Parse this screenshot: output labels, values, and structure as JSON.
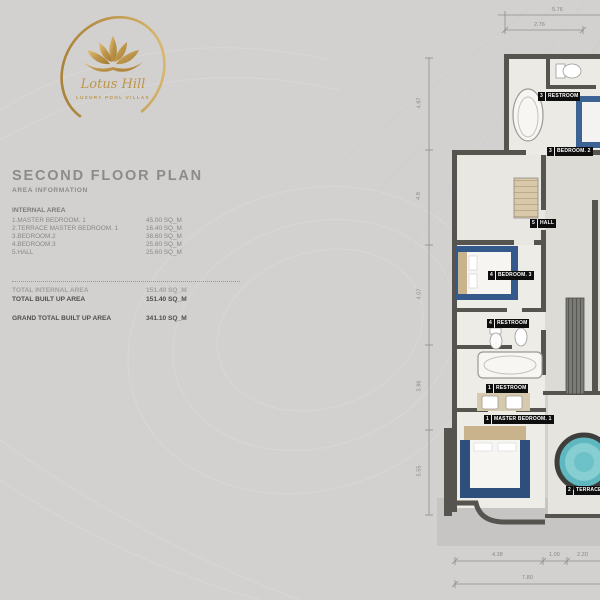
{
  "brand": {
    "name": "Lotus Hill",
    "tagline": "LUXURY POOL VILLAS"
  },
  "heading": {
    "title": "SECOND FLOOR PLAN",
    "subtitle": "AREA INFORMATION"
  },
  "internal_area": {
    "section_label": "INTERNAL AREA",
    "rows": [
      {
        "label": "1.MASTER BEDROOM. 1",
        "value": "45.00 SQ_M"
      },
      {
        "label": "2.TERRACE MASTER BEDROOM. 1",
        "value": "16.40 SQ_M"
      },
      {
        "label": "3.BEDROOM.2",
        "value": "38.60 SQ_M"
      },
      {
        "label": "4.BEDROOM.3",
        "value": "25.80 SQ_M"
      },
      {
        "label": "5.HALL",
        "value": "25.60 SQ_M"
      }
    ]
  },
  "totals": {
    "internal": {
      "label": "TOTAL INTERNAL AREA",
      "value": "151.40 SQ_M"
    },
    "built_up": {
      "label": "TOTAL BUILT UP AREA",
      "value": "151.40 SQ_M"
    },
    "grand": {
      "label": "GRAND TOTAL BUILT UP AREA",
      "value": "341.10 SQ_M"
    }
  },
  "plan": {
    "rooms": [
      {
        "num": "3",
        "name": "RESTROOM"
      },
      {
        "num": "3",
        "name": "BEDROOM. 2"
      },
      {
        "num": "5",
        "name": "HALL"
      },
      {
        "num": "4",
        "name": "BEDROOM. 3"
      },
      {
        "num": "4",
        "name": "RESTROOM"
      },
      {
        "num": "1",
        "name": "RESTROOM"
      },
      {
        "num": "1",
        "name": "MASTER BEDROOM. 1"
      },
      {
        "num": "2",
        "name": "TERRACE"
      }
    ],
    "dimensions": {
      "top_outer": "5.76",
      "top_inner": "2.76",
      "left": [
        "4.97",
        "4.8",
        "4.07",
        "3.96",
        "5.55"
      ],
      "bottom_segments": [
        "4.38",
        "1.00",
        "2.20"
      ],
      "bottom_total": "7.80"
    }
  },
  "colors": {
    "gold": "#bd954a",
    "background": "#d3d1d0",
    "wall": "#56544e",
    "bed_blue": "#35598a",
    "pool_teal": "#5fb7c0"
  }
}
